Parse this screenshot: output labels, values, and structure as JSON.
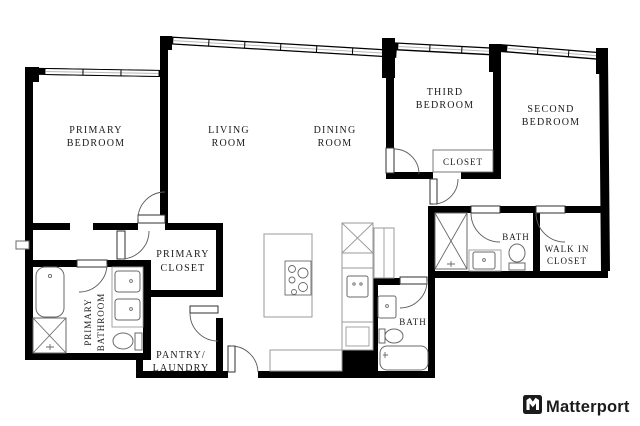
{
  "branding": {
    "logo_text": "Matterport",
    "logo_icon": "matterport-m-icon"
  },
  "colors": {
    "wall": "#000000",
    "background": "#ffffff",
    "fixture_stroke": "#6a6a6a",
    "cabinet_stroke": "#9a9a9a",
    "label_text": "#1a1a1a",
    "logo": "#1b1b1b"
  },
  "rooms": {
    "primary_bedroom": {
      "line1": "PRIMARY",
      "line2": "BEDROOM"
    },
    "living_room": {
      "line1": "LIVING",
      "line2": "ROOM"
    },
    "dining_room": {
      "line1": "DINING",
      "line2": "ROOM"
    },
    "third_bedroom": {
      "line1": "THIRD",
      "line2": "BEDROOM"
    },
    "second_bedroom": {
      "line1": "SECOND",
      "line2": "BEDROOM"
    },
    "bedroom_closet": {
      "label": "CLOSET"
    },
    "bath": {
      "label": "BATH"
    },
    "walk_in_closet": {
      "line1": "WALK IN",
      "line2": "CLOSET"
    },
    "primary_closet": {
      "line1": "PRIMARY",
      "line2": "CLOSET"
    },
    "primary_bathroom": {
      "line1": "PRIMARY",
      "line2": "BATHROOM"
    },
    "pantry_laundry": {
      "line1": "PANTRY/",
      "line2": "LAUNDRY"
    },
    "bath_second": {
      "label": "BATH"
    }
  }
}
